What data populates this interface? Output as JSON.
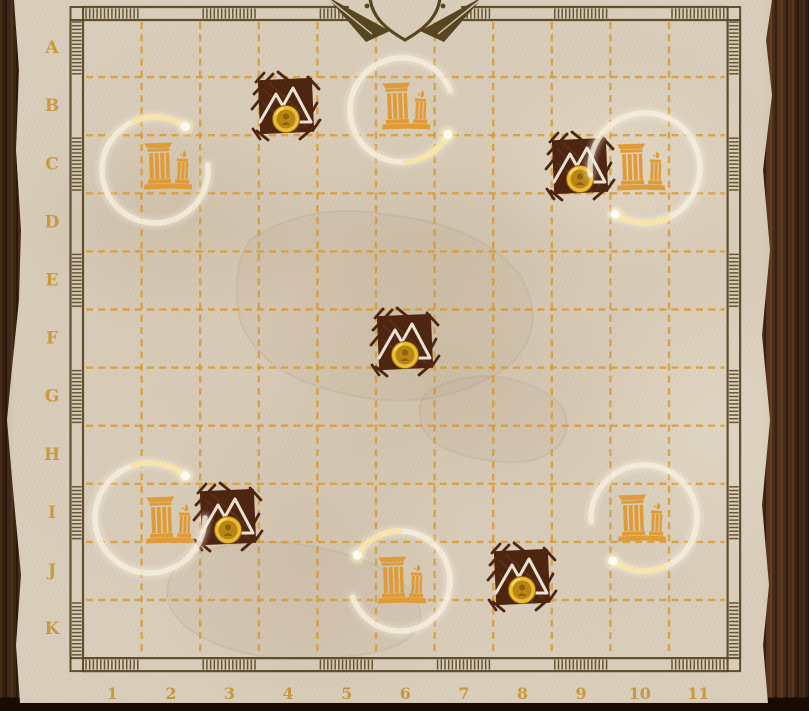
{
  "board": {
    "name": "treasure-map-grid",
    "grid_rows": 11,
    "grid_cols": 11,
    "row_labels": [
      "A",
      "B",
      "C",
      "D",
      "E",
      "F",
      "G",
      "H",
      "I",
      "J",
      "K"
    ],
    "col_labels": [
      "1",
      "2",
      "3",
      "4",
      "5",
      "6",
      "7",
      "8",
      "9",
      "10",
      "11"
    ]
  },
  "features": {
    "mountain_gold_tiles": [
      {
        "cell": "B4",
        "x": 286,
        "y": 106,
        "coin": true
      },
      {
        "cell": "C9",
        "x": 580,
        "y": 166,
        "coin": true
      },
      {
        "cell": "F6",
        "x": 405,
        "y": 342,
        "coin": true
      },
      {
        "cell": "I3",
        "x": 228,
        "y": 517,
        "coin": true
      },
      {
        "cell": "J8",
        "x": 522,
        "y": 577,
        "coin": true
      }
    ],
    "temple_ruins": [
      {
        "cell": "C2",
        "x": 166,
        "y": 166
      },
      {
        "cell": "B6",
        "x": 404,
        "y": 106
      },
      {
        "cell": "C10",
        "x": 639,
        "y": 167
      },
      {
        "cell": "I2",
        "x": 168,
        "y": 520
      },
      {
        "cell": "J6",
        "x": 400,
        "y": 580
      },
      {
        "cell": "I10",
        "x": 640,
        "y": 518
      }
    ],
    "selection_rings": [
      {
        "cell": "C2",
        "x": 155,
        "y": 170,
        "r": 53,
        "dot_angle": 55,
        "dir": 1
      },
      {
        "cell": "B6",
        "x": 402,
        "y": 110,
        "r": 52,
        "dot_angle": -28,
        "dir": -1
      },
      {
        "cell": "C10",
        "x": 645,
        "y": 168,
        "r": 55,
        "dot_angle": 237,
        "dir": 1
      },
      {
        "cell": "I2",
        "x": 150,
        "y": 518,
        "r": 55,
        "dot_angle": 50,
        "dir": 1
      },
      {
        "cell": "J6",
        "x": 400,
        "y": 581,
        "r": 50,
        "dot_angle": 149,
        "dir": -1
      },
      {
        "cell": "I10",
        "x": 644,
        "y": 518,
        "r": 53,
        "dot_angle": 234,
        "dir": 1
      }
    ]
  },
  "decorations": {
    "compass": {
      "type": "compass-rose-partial",
      "x": 405,
      "y": 0
    }
  },
  "colors": {
    "parchment": "#d9cdbb",
    "wood": "#4a2c16",
    "grid_dash": "#d79a2e",
    "label_gold": "#c69631",
    "frame_ink": "#54431f",
    "tile_brown": "#4b220d",
    "mountain_outline": "#ece4d4",
    "coin_gold": "#edbd2a",
    "temple_orange": "#e09b33",
    "ring_cream": "#f7f0df",
    "ring_dot": "#fffef6"
  }
}
